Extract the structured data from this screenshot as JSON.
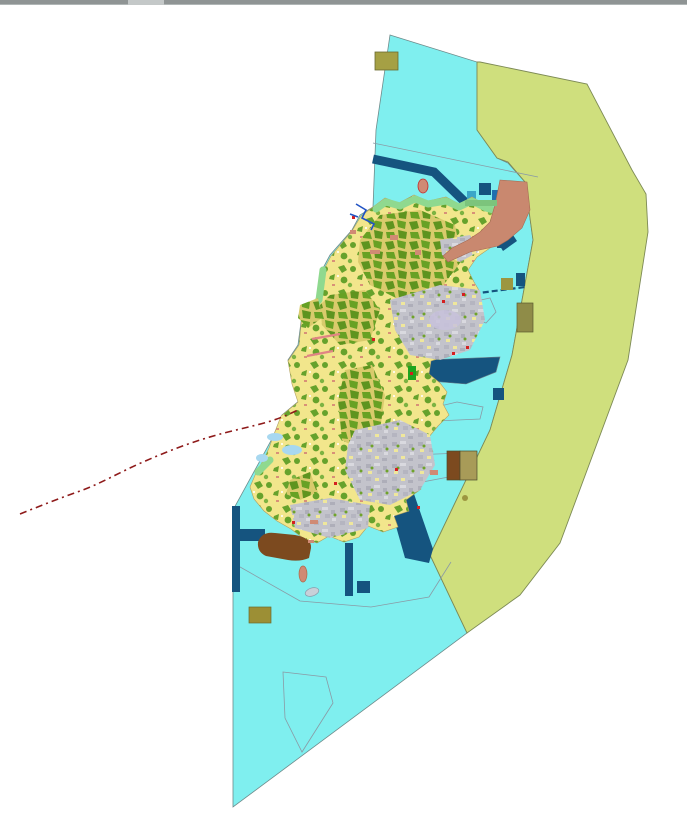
{
  "window": {
    "chrome": {
      "top_bar_color": "#8F9494",
      "top_bar_highlight": "#C4C8C8"
    }
  },
  "map": {
    "background_color": "#FFFFFF",
    "zones": {
      "sea": {
        "label": "coastal-waters",
        "color": "#7FEFEF"
      },
      "buffer": {
        "label": "outer-buffer-zone",
        "color": "#CFDF7D"
      },
      "agri": {
        "label": "agricultural-land",
        "color": "#F2E68C"
      },
      "forest": {
        "label": "forest-orchard-patches",
        "color": "#66A22C"
      },
      "urban": {
        "label": "built-up-area",
        "color": "#C3C3CB"
      },
      "coast": {
        "label": "coastal-greenbelt",
        "color": "#8FD98F"
      },
      "port": {
        "label": "port-structures",
        "color": "#15547F"
      },
      "salmon": {
        "label": "reclamation-area",
        "color": "#C9886F"
      },
      "brown": {
        "label": "harbor-works",
        "color": "#7C4A1F"
      },
      "olive": {
        "label": "facility-parcel",
        "color": "#9C9640"
      },
      "boundary": {
        "label": "administrative-boundary",
        "color": "#8E1A1A"
      },
      "river": {
        "label": "river",
        "color": "#2153C4"
      }
    }
  }
}
